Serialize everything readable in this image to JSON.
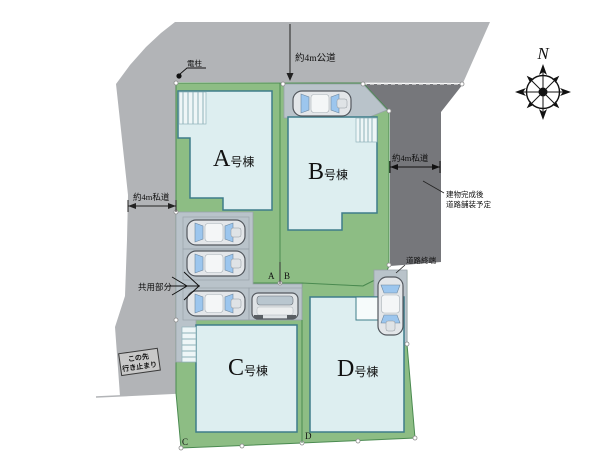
{
  "plan": {
    "compass_label": "N",
    "roads": {
      "top_label": "約4m公道",
      "left_label": "約4m私道",
      "right_label": "約4m私道",
      "paving_note_line1": "建物完成後",
      "paving_note_line2": "道路舗装予定",
      "road_end_label": "道路終端"
    },
    "annotations": {
      "utility_pole_label": "電柱",
      "shared_area_label": "共用部分",
      "dead_end_line1": "この先",
      "dead_end_line2": "行き止まり"
    },
    "buildings": [
      {
        "letter": "A",
        "suffix": "号棟"
      },
      {
        "letter": "B",
        "suffix": "号棟"
      },
      {
        "letter": "C",
        "suffix": "号棟"
      },
      {
        "letter": "D",
        "suffix": "号棟"
      }
    ],
    "boundary_markers": {
      "a": "A",
      "b": "B",
      "c": "C",
      "d": "D"
    },
    "colors": {
      "road_light": "#b2b4b7",
      "road_dark": "#76777b",
      "lot_green": "#8dbd84",
      "parking_gray": "#b9c3ca",
      "building_fill": "#ddeef0",
      "building_border": "#3e7d8a"
    }
  }
}
